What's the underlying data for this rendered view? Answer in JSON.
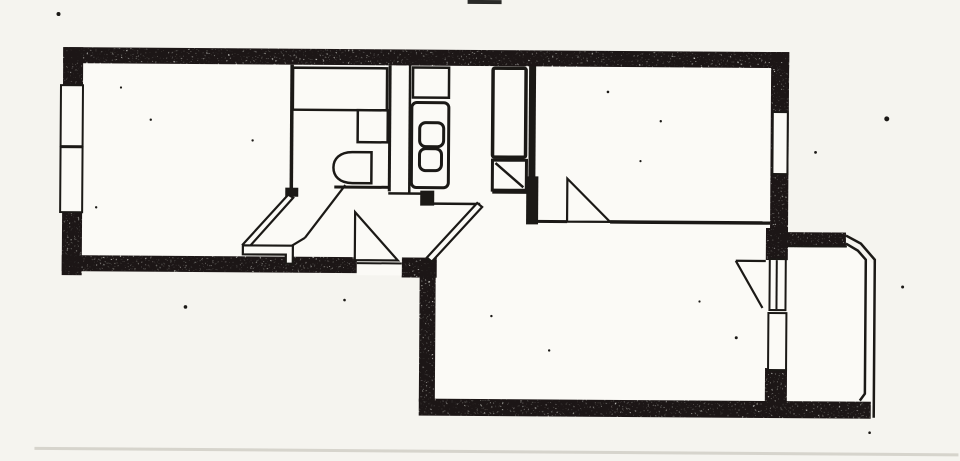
{
  "page": {
    "background": "#f5f4ef",
    "paper": "#fbfaf6",
    "ink": "#1b1916",
    "faint_line_color": "#b7b4aa"
  },
  "plan": {
    "elements": [
      {
        "name": "floor-living-room",
        "kind": "rect",
        "x": 76,
        "y": 60,
        "w": 700,
        "h": 204,
        "fill": "paper"
      },
      {
        "name": "floor-lower-room",
        "kind": "rect",
        "x": 430,
        "y": 214,
        "w": 344,
        "h": 190,
        "fill": "paper"
      },
      {
        "name": "floor-balcony",
        "kind": "polygon",
        "points": "778,238 846,238 875,262 875,403 778,403",
        "fill": "paper"
      },
      {
        "name": "bathroom-wall-left",
        "kind": "line",
        "x1": 291,
        "y1": 66,
        "x2": 291,
        "y2": 190,
        "sw": 3.5
      },
      {
        "name": "bathroom-door-jamb",
        "kind": "rect",
        "x": 285,
        "y": 189,
        "w": 13,
        "h": 9,
        "fill": "ink"
      },
      {
        "name": "bathroom-wall-right",
        "kind": "line",
        "x1": 389,
        "y1": 66,
        "x2": 389,
        "y2": 192,
        "sw": 3
      },
      {
        "name": "duct-wall-right",
        "kind": "line",
        "x1": 409,
        "y1": 66,
        "x2": 409,
        "y2": 195,
        "sw": 2.5
      },
      {
        "name": "bathroom-wall-south",
        "kind": "line",
        "x1": 334,
        "y1": 188,
        "x2": 390,
        "y2": 188,
        "sw": 3
      },
      {
        "name": "duct-wall-south",
        "kind": "line",
        "x1": 388,
        "y1": 194,
        "x2": 421,
        "y2": 194,
        "sw": 2.5
      },
      {
        "name": "kitchen-wall-stub-left",
        "kind": "rect",
        "x": 420,
        "y": 191,
        "w": 14,
        "h": 15,
        "fill": "ink"
      },
      {
        "name": "kitchen-wall-south",
        "kind": "line",
        "x1": 492,
        "y1": 192,
        "x2": 529,
        "y2": 192,
        "sw": 3
      },
      {
        "name": "kitchen-wall-right",
        "kind": "rect",
        "x": 528,
        "y": 64,
        "w": 7,
        "h": 114,
        "fill": "ink"
      },
      {
        "name": "kitchen-wall-right-stub",
        "kind": "rect",
        "x": 526,
        "y": 176,
        "w": 12,
        "h": 48,
        "fill": "ink"
      },
      {
        "name": "bedroom-wall-south-west",
        "kind": "line",
        "x1": 535,
        "y1": 221,
        "x2": 567,
        "y2": 221,
        "sw": 3
      },
      {
        "name": "bedroom-wall-south-east",
        "kind": "line",
        "x1": 610,
        "y1": 221,
        "x2": 770,
        "y2": 221,
        "sw": 3.5
      },
      {
        "name": "kitchen-door-leaf",
        "kind": "line",
        "x1": 433,
        "y1": 204,
        "x2": 480,
        "y2": 204,
        "sw": 2.5
      },
      {
        "name": "bathtub",
        "kind": "rect",
        "x": 292,
        "y": 69,
        "w": 94,
        "h": 42,
        "fill": "paper",
        "sw": 2.5
      },
      {
        "name": "bathroom-sink",
        "kind": "rect",
        "x": 357,
        "y": 111,
        "w": 30,
        "h": 32,
        "fill": "paper",
        "sw": 2.5
      },
      {
        "name": "toilet",
        "kind": "path",
        "d": "M371,153 L352,153 C339,153 333,160 333,168.5 C333,177 339,184 352,184 L371,184 Z",
        "fill": "paper",
        "sw": 2.5
      },
      {
        "name": "kitchen-sink",
        "kind": "rect",
        "x": 412,
        "y": 68,
        "w": 36,
        "h": 30,
        "fill": "paper",
        "sw": 2.5
      },
      {
        "name": "stove",
        "kind": "rect",
        "x": 411,
        "y": 103,
        "w": 37,
        "h": 85,
        "rx": 5,
        "fill": "paper",
        "sw": 3
      },
      {
        "name": "stove-burner-1",
        "kind": "rect",
        "x": 419,
        "y": 123,
        "w": 24,
        "h": 24,
        "rx": 6,
        "fill": "paper",
        "sw": 3
      },
      {
        "name": "stove-burner-2",
        "kind": "rect",
        "x": 419,
        "y": 149,
        "w": 22,
        "h": 22,
        "rx": 6,
        "fill": "paper",
        "sw": 3
      },
      {
        "name": "fridge-cabinet",
        "kind": "rect",
        "x": 492,
        "y": 68,
        "w": 33,
        "h": 89,
        "rx": 2,
        "fill": "paper",
        "sw": 3.5
      },
      {
        "name": "counter-unit",
        "kind": "rect",
        "x": 492,
        "y": 160,
        "w": 34,
        "h": 30,
        "fill": "paper",
        "sw": 3
      },
      {
        "name": "counter-unit-diagonal",
        "kind": "line",
        "x1": 495,
        "y1": 163,
        "x2": 523,
        "y2": 187,
        "sw": 2.5
      },
      {
        "name": "wall-top",
        "kind": "rect",
        "x": 62,
        "y": 50,
        "w": 726,
        "h": 16,
        "fill": "ink",
        "speckle": true
      },
      {
        "name": "wall-left",
        "kind": "rect",
        "x": 62,
        "y": 50,
        "w": 20,
        "h": 228,
        "fill": "ink",
        "speckle": true
      },
      {
        "name": "wall-bottom-left",
        "kind": "rect",
        "x": 62,
        "y": 258,
        "w": 298,
        "h": 16,
        "fill": "ink",
        "speckle": true
      },
      {
        "name": "wall-entrance-right",
        "kind": "rect",
        "x": 402,
        "y": 258,
        "w": 35,
        "h": 20,
        "fill": "ink",
        "speckle": true
      },
      {
        "name": "wall-lower-room-left",
        "kind": "rect",
        "x": 420,
        "y": 262,
        "w": 16,
        "h": 140,
        "fill": "ink",
        "speckle": true
      },
      {
        "name": "wall-lower-room-bottom",
        "kind": "rect",
        "x": 420,
        "y": 399,
        "w": 452,
        "h": 17,
        "fill": "ink",
        "speckle": true
      },
      {
        "name": "wall-right",
        "kind": "rect",
        "x": 770,
        "y": 50,
        "w": 18,
        "h": 196,
        "fill": "ink",
        "speckle": true
      },
      {
        "name": "wall-balcony-divider-top",
        "kind": "rect",
        "x": 766,
        "y": 226,
        "w": 22,
        "h": 32,
        "fill": "ink",
        "speckle": true
      },
      {
        "name": "wall-balcony-divider-low",
        "kind": "rect",
        "x": 766,
        "y": 366,
        "w": 22,
        "h": 36,
        "fill": "ink",
        "speckle": true
      },
      {
        "name": "wall-balcony-top",
        "kind": "rect",
        "x": 783,
        "y": 230,
        "w": 63,
        "h": 15,
        "fill": "ink",
        "speckle": true
      },
      {
        "name": "window-left-1",
        "kind": "rect",
        "x": 60,
        "y": 88,
        "w": 22,
        "h": 61,
        "fill": "paper",
        "sw": 2
      },
      {
        "name": "window-left-2",
        "kind": "rect",
        "x": 60,
        "y": 150,
        "w": 22,
        "h": 65,
        "fill": "paper",
        "sw": 2
      },
      {
        "name": "window-right",
        "kind": "rect",
        "x": 772,
        "y": 110,
        "w": 15,
        "h": 62,
        "fill": "paper",
        "sw": 2
      },
      {
        "name": "entrance-opening",
        "kind": "rect",
        "x": 357,
        "y": 254,
        "w": 45,
        "h": 22,
        "fill": "paper"
      },
      {
        "name": "entrance-door-line",
        "kind": "line",
        "x1": 357,
        "y1": 264,
        "x2": 402,
        "y2": 264,
        "sw": 2
      },
      {
        "name": "balcony-door-panel",
        "kind": "rect",
        "x": 770,
        "y": 257,
        "w": 16,
        "h": 51,
        "fill": "paper",
        "sw": 2
      },
      {
        "name": "balcony-door-panel-line",
        "kind": "line",
        "x1": 777,
        "y1": 258,
        "x2": 777,
        "y2": 307,
        "sw": 2
      },
      {
        "name": "window-balcony-wall",
        "kind": "rect",
        "x": 769,
        "y": 311,
        "w": 18,
        "h": 57,
        "fill": "paper",
        "sw": 2
      },
      {
        "name": "living-room-door-leaf",
        "kind": "polygon",
        "points": "288,196 293,199 248,250 243,246",
        "fill": "paper",
        "sw": 2.2
      },
      {
        "name": "living-room-door-step",
        "kind": "polygon",
        "points": "243,247 293,247 293,265 286,265 286,256 243,256",
        "fill": "paper",
        "sw": 2.2
      },
      {
        "name": "bathroom-door-leaf",
        "kind": "line",
        "x1": 345,
        "y1": 186,
        "x2": 305,
        "y2": 239,
        "sw": 2.2
      },
      {
        "name": "bathroom-door-leaf-end",
        "kind": "line",
        "x1": 305,
        "y1": 239,
        "x2": 292,
        "y2": 247,
        "sw": 2.2
      },
      {
        "name": "entrance-door-swing",
        "kind": "polygon",
        "points": "355,213 355,261 398,261",
        "fill": "paper",
        "sw": 2.2
      },
      {
        "name": "lower-room-door-leaf",
        "kind": "polygon",
        "points": "477,203 482,207 432,262 427,258",
        "fill": "paper",
        "sw": 2.2
      },
      {
        "name": "bedroom-door-swing",
        "kind": "polygon",
        "points": "567,178 567,221 610,221",
        "fill": "paper",
        "sw": 2.2
      },
      {
        "name": "balcony-door-swing-top",
        "kind": "line",
        "x1": 766,
        "y1": 259,
        "x2": 736,
        "y2": 259,
        "sw": 2.2
      },
      {
        "name": "balcony-door-swing-arc",
        "kind": "line",
        "x1": 736,
        "y1": 259,
        "x2": 763,
        "y2": 306,
        "sw": 2.2
      },
      {
        "name": "balcony-rail-outer",
        "kind": "polyline",
        "points": "846,233 861,241 875,257 875,415",
        "sw": 2.5
      },
      {
        "name": "balcony-rail-inner",
        "kind": "polyline",
        "points": "846,241 858,248 866,257 866,391 861,398",
        "sw": 2.5
      },
      {
        "name": "balcony-rail-top-inner",
        "kind": "line",
        "x1": 788,
        "y1": 244,
        "x2": 847,
        "y2": 244,
        "sw": 2
      },
      {
        "name": "page-edge-line",
        "kind": "rect",
        "x": 36,
        "y": 450,
        "w": 924,
        "h": 3,
        "fill": "#b7b4aa",
        "opacity": 0.5
      },
      {
        "name": "scan-mark-top",
        "kind": "rect",
        "x": 466,
        "y": 0,
        "w": 34,
        "h": 4,
        "fill": "#2a2a28"
      },
      {
        "name": "scan-speck",
        "kind": "dot",
        "x": 886,
        "y": 116,
        "r": 2.5,
        "fill": "ink"
      },
      {
        "name": "scan-speck",
        "kind": "dot",
        "x": 57,
        "y": 17,
        "r": 2,
        "fill": "ink"
      },
      {
        "name": "scan-speck",
        "kind": "dot",
        "x": 186,
        "y": 309,
        "r": 1.8,
        "fill": "ink"
      },
      {
        "name": "scan-speck",
        "kind": "dot",
        "x": 903,
        "y": 284,
        "r": 1.5,
        "fill": "ink"
      },
      {
        "name": "scan-speck",
        "kind": "dot",
        "x": 737,
        "y": 336,
        "r": 1.5,
        "fill": "ink"
      },
      {
        "name": "scan-speck",
        "kind": "dot",
        "x": 607,
        "y": 91,
        "r": 1.3,
        "fill": "ink"
      },
      {
        "name": "scan-speck",
        "kind": "dot",
        "x": 345,
        "y": 301,
        "r": 1.3,
        "fill": "ink"
      },
      {
        "name": "scan-speck",
        "kind": "dot",
        "x": 871,
        "y": 430,
        "r": 1.3,
        "fill": "ink"
      },
      {
        "name": "scan-speck",
        "kind": "dot",
        "x": 150,
        "y": 122,
        "r": 1.2,
        "fill": "ink"
      },
      {
        "name": "scan-speck",
        "kind": "dot",
        "x": 252,
        "y": 142,
        "r": 1.2,
        "fill": "ink"
      },
      {
        "name": "scan-speck",
        "kind": "dot",
        "x": 492,
        "y": 316,
        "r": 1.2,
        "fill": "ink"
      },
      {
        "name": "scan-speck",
        "kind": "dot",
        "x": 660,
        "y": 120,
        "r": 1.2,
        "fill": "ink"
      },
      {
        "name": "scan-speck",
        "kind": "dot",
        "x": 96,
        "y": 210,
        "r": 1.2,
        "fill": "ink"
      },
      {
        "name": "scan-speck",
        "kind": "dot",
        "x": 550,
        "y": 350,
        "r": 1.2,
        "fill": "ink"
      },
      {
        "name": "scan-speck",
        "kind": "dot",
        "x": 700,
        "y": 300,
        "r": 1.1,
        "fill": "ink"
      },
      {
        "name": "scan-speck",
        "kind": "dot",
        "x": 815,
        "y": 150,
        "r": 1.4,
        "fill": "ink"
      },
      {
        "name": "scan-speck",
        "kind": "dot",
        "x": 120,
        "y": 90,
        "r": 1.1,
        "fill": "ink"
      },
      {
        "name": "scan-speck",
        "kind": "dot",
        "x": 640,
        "y": 160,
        "r": 1.1,
        "fill": "ink"
      }
    ]
  }
}
